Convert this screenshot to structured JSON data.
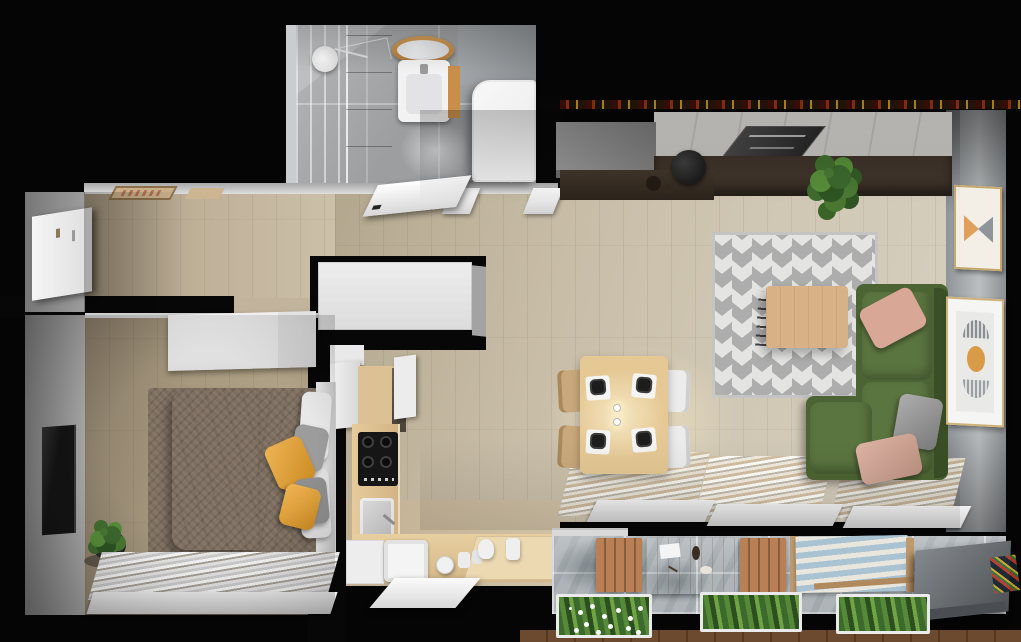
{
  "scene": {
    "title": "Apartment 3D Floor Plan — Top-Down Render",
    "view": "top-down 3d architectural render",
    "rooms": [
      "bathroom",
      "hallway",
      "bedroom",
      "kitchen",
      "living-dining-room",
      "balcony"
    ]
  },
  "colors": {
    "wall_cut": "#070707",
    "wood_floor": "#c8bda7",
    "bedroom_floor": "#ac9d82",
    "bathroom_tile": "#9c9ea0",
    "sofa_green": "#4c6433",
    "sofa_cushion_green": "#5b7540",
    "pillow_pink": "#d8a795",
    "pillow_gray": "#9c9c9c",
    "accent_yellow": "#e9a22c",
    "bedroom_rug": "#7d6e5f",
    "living_rug_gray": "#ababab",
    "living_rug_white": "#e7e7e5",
    "coffee_table_wood": "#d8b286",
    "dining_table_wood": "#e5c894",
    "chair_wood": "#c9a97c",
    "chair_white": "#ececec",
    "counter_wood": "#dcc194",
    "sideboard_dark": "#3f342a",
    "marble_wall": "#d6d4cf",
    "balcony_stone": "#aeb4b8",
    "divider_gray": "#6e7478",
    "plant_green": "#4a7a33",
    "lounger_blue": "#a9c3d3",
    "tv_black": "#141414",
    "headboard_white": "#e0e0e0",
    "bathtub_white": "#efefef"
  },
  "rooms": {
    "bathroom": {
      "name": "Bathroom",
      "items": [
        "walk-in shower",
        "rain shower head",
        "dark tiled wall",
        "round wood-framed mirror",
        "wall-hung washbasin",
        "bathtub",
        "open door"
      ]
    },
    "hallway": {
      "name": "Entrance Hall",
      "items": [
        "entry door",
        "doormats",
        "utility shaft"
      ]
    },
    "bedroom": {
      "name": "Bedroom",
      "items": [
        "double bed",
        "white duvet",
        "taupe blanket",
        "yellow cushions",
        "gray cushions",
        "headboard",
        "fluffy brown rug",
        "wall-mounted TV",
        "white wardrobe",
        "potted plant",
        "window blinds",
        "window sill"
      ]
    },
    "kitchen": {
      "name": "Kitchen",
      "items": [
        "induction hob",
        "prep sink",
        "main sink",
        "L-shaped wood counter",
        "white tall cabinets",
        "dishwasher front",
        "kettle",
        "canisters",
        "pitcher"
      ]
    },
    "living_room": {
      "name": "Living / Dining Room",
      "items": [
        "green corner sofa",
        "pink cushions",
        "gray cushion",
        "geometric chevron rug",
        "wood coffee table",
        "wire magazine rack",
        "dining table for four",
        "black plates on mats",
        "white chairs",
        "wood chairs",
        "pendant lamps",
        "dark sideboard",
        "marble feature wall",
        "leaning TV panel",
        "bar stool",
        "potted plant",
        "tall gray cabinet",
        "framed artwork bowtie",
        "framed artwork arcs",
        "panoramic windows with blinds"
      ]
    },
    "balcony": {
      "name": "Balcony Terrace",
      "items": [
        "stone tile floor",
        "wood dining table",
        "two wood benches",
        "striped lounger",
        "three planter boxes",
        "white flowers",
        "privacy divider",
        "wood deck edge"
      ]
    }
  }
}
